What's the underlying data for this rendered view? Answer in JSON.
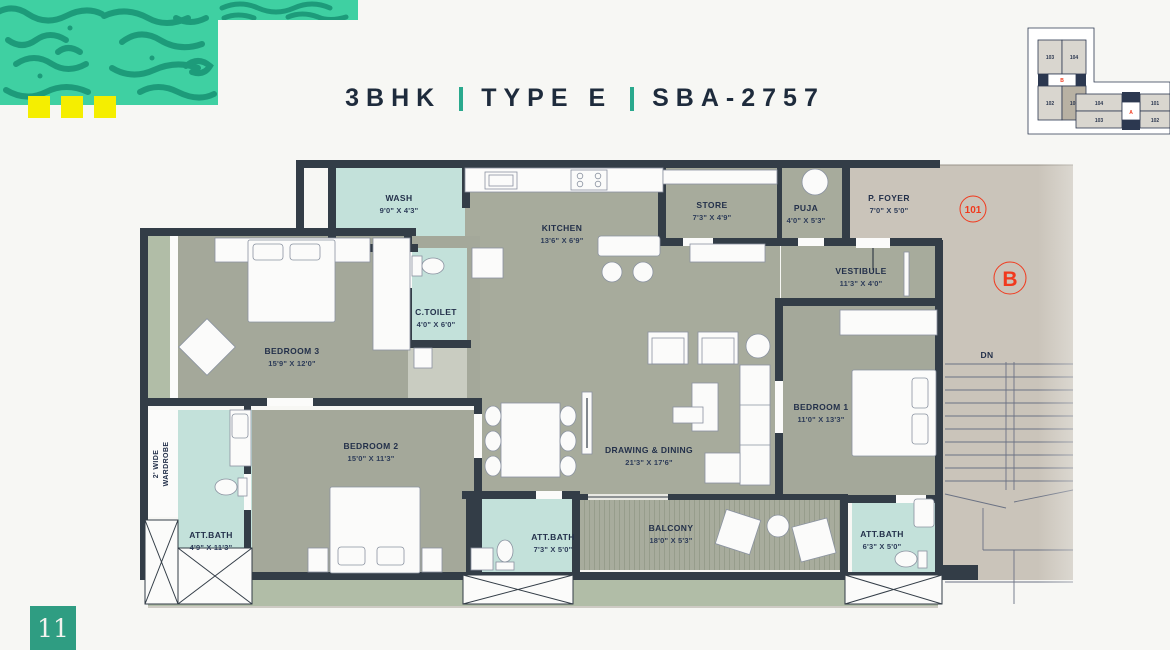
{
  "header": {
    "title_part1": "3BHK",
    "title_part2": "TYPE E",
    "title_part3": "SBA-2757"
  },
  "floor_plan": {
    "rooms": {
      "wash": {
        "name": "WASH",
        "dims": "9'0\" X 4'3\""
      },
      "kitchen": {
        "name": "KITCHEN",
        "dims": "13'6\" X 6'9\""
      },
      "store": {
        "name": "STORE",
        "dims": "7'3\" X 4'9\""
      },
      "puja": {
        "name": "PUJA",
        "dims": "4'0\" X 5'3\""
      },
      "p_foyer": {
        "name": "P. FOYER",
        "dims": "7'0\" X 5'0\""
      },
      "vestibule": {
        "name": "VESTIBULE",
        "dims": "11'3\" X 4'0\""
      },
      "c_toilet": {
        "name": "C.TOILET",
        "dims": "4'0\" X 6'0\""
      },
      "bedroom_3": {
        "name": "BEDROOM 3",
        "dims": "15'9\" X 12'0\""
      },
      "bedroom_2": {
        "name": "BEDROOM 2",
        "dims": "15'0\" X 11'3\""
      },
      "bedroom_1": {
        "name": "BEDROOM 1",
        "dims": "11'0\" X 13'3\""
      },
      "drawing_dining": {
        "name": "DRAWING & DINING",
        "dims": "21'3\" X 17'6\""
      },
      "balcony": {
        "name": "BALCONY",
        "dims": "18'0\" X 5'3\""
      },
      "att_bath_2": {
        "name": "ATT.BATH",
        "dims": "4'9\" X 11'3\""
      },
      "att_bath_common": {
        "name": "ATT.BATH",
        "dims": "7'3\" X 5'0\""
      },
      "att_bath_1": {
        "name": "ATT.BATH",
        "dims": "6'3\" X 5'0\""
      }
    },
    "wardrobe": {
      "line1": "2' WIDE",
      "line2": "WARDROBE"
    },
    "markers": {
      "unit_number": "101",
      "block_letter": "B",
      "stairs": "DN",
      "color": "#f1391d"
    }
  },
  "key_plan": {
    "left_block": {
      "units": [
        "103",
        "104",
        "102",
        "101"
      ],
      "core": "B",
      "highlighted_unit": "101"
    },
    "right_block": {
      "units": [
        "104",
        "101",
        "103",
        "102"
      ],
      "core": "A"
    }
  },
  "footer": {
    "page_number": "11"
  },
  "colors": {
    "background": "#f7f7f4",
    "pattern_teal": "#3fd0a2",
    "squiggle": "#1d9b7a",
    "yellow": "#f5ee00",
    "title_navy": "#1e2b3c",
    "accent_teal": "#2aa98d",
    "wall": "#333d47",
    "floor": "#a7ab9c",
    "bath_floor": "#c3e1da",
    "foyer_floor": "#cac4ba",
    "sage": "#b1bda7",
    "marker_red": "#f1391d",
    "page_badge": "#2f9d82"
  }
}
